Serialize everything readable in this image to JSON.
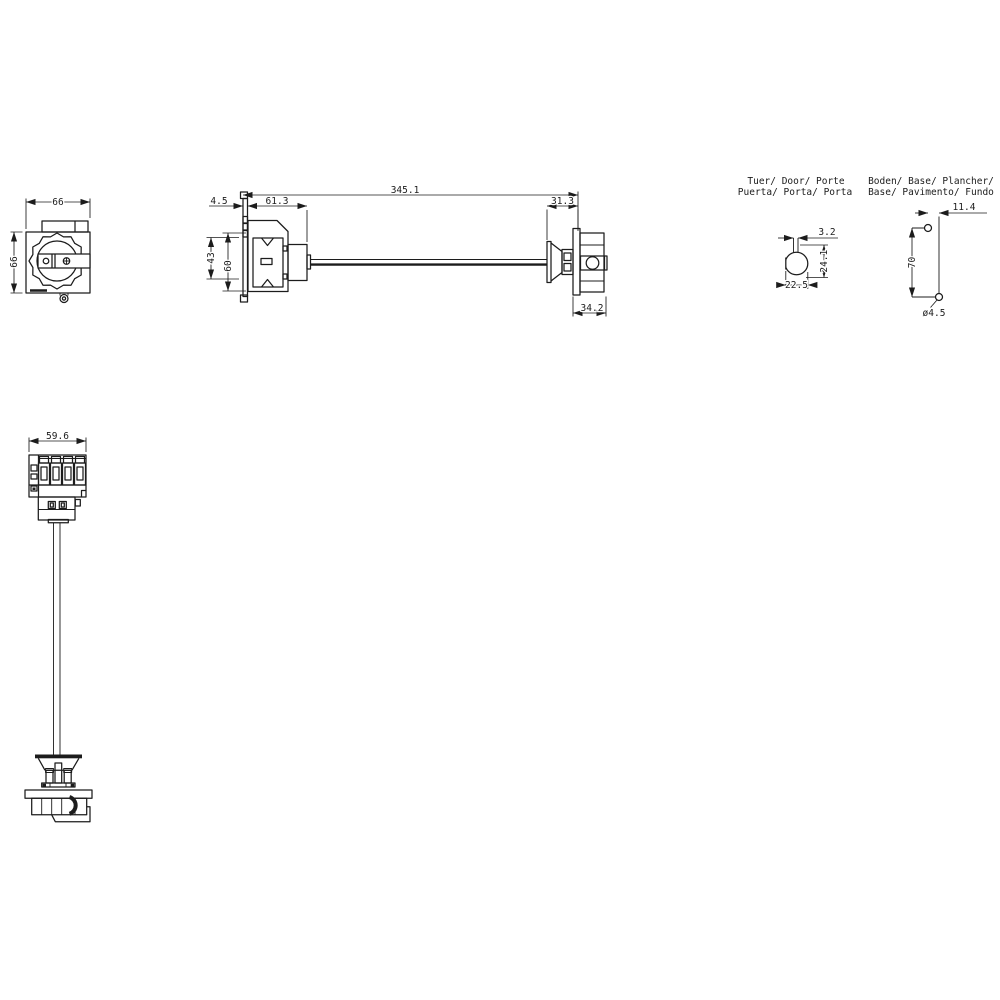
{
  "meta": {
    "background": "#ffffff",
    "line_color": "#1c1c1c"
  },
  "views": {
    "handle_front": {
      "name": "rotary-handle-front-view",
      "dim_width": "66",
      "dim_height": "66"
    },
    "assembly_side": {
      "name": "switch-with-extension-shaft-side-view",
      "dim_total_length": "345.1",
      "dim_bracket_thickness": "4.5",
      "dim_body_depth": "61.3",
      "dim_handle_depth": "31.3",
      "dim_handle_width": "34.2",
      "dim_inner_height": "43",
      "dim_body_height": "60"
    },
    "door_cutout": {
      "label_line1": "Tuer/ Door/ Porte",
      "label_line2": "Puerta/ Porta/ Porta",
      "dim_slot_width": "3.2",
      "dim_cutout_height": "24.1",
      "dim_cutout_width": "22.5"
    },
    "base_drilling": {
      "label_line1": "Boden/ Base/ Plancher/",
      "label_line2": "Base/ Pavimento/ Fundo",
      "dim_hole_offset": "11.4",
      "dim_hole_spacing": "70",
      "dim_hole_diameter": "ø4.5"
    },
    "switch_front": {
      "name": "switch-body-front-view-with-shaft",
      "dim_width": "59.6"
    }
  }
}
